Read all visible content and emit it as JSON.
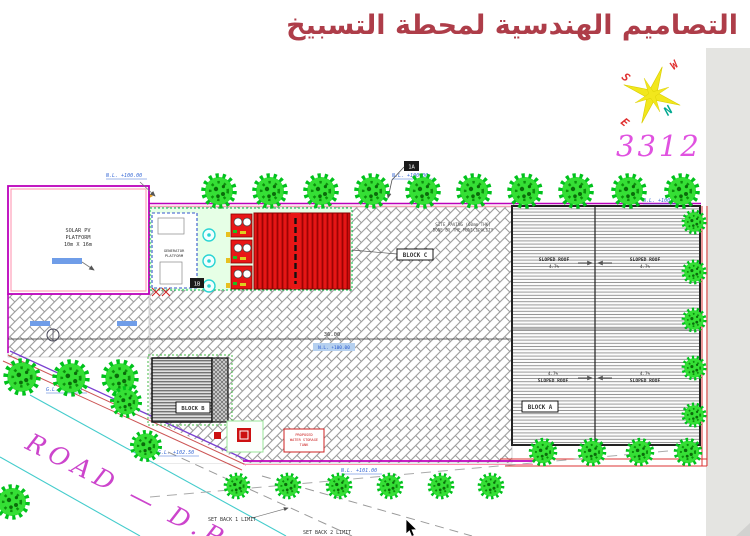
{
  "slide": {
    "title": "التصاميم الهندسية لمحطة التسبيخ",
    "drawing_number": "3312"
  },
  "colors": {
    "title": "#ae3d49",
    "drawing_number": "#e052e0",
    "road_text": "#cc44cc",
    "boundary_purple": "#bb00bb",
    "boundary_red": "#dd3333",
    "container_red": "#e51616",
    "tree_green": "#35df35",
    "level_text_blue": "#3a6bd6"
  },
  "compass": {
    "north": "N",
    "south": "S",
    "east": "E",
    "west": "W"
  },
  "plan": {
    "solar_platform": {
      "line1": "SOLAR PV",
      "line2": "PLATFORM",
      "line3": "10m X 16m"
    },
    "generator_platform": {
      "line1": "GENERATOR",
      "line2": "PLATFORM"
    },
    "blocks": {
      "a": "BLOCK A",
      "b": "BLOCK B",
      "c": "BLOCK C"
    },
    "sloped_roof": {
      "label": "SLOPED ROOF",
      "slope": "4.7%"
    },
    "municipality_note": {
      "line1": "SITE PAVING (60mm THK)",
      "line2": "DONE BY THE MUNICIPALITY"
    },
    "water_tank_note": {
      "line1": "PROPOSED",
      "line2": "WATER STORAGE",
      "line3": "TANK"
    },
    "levels": {
      "nl_100": "N.L. +100.00",
      "nl_101": "N.L. +101.00",
      "gl_100_50": "G.L. +100.50",
      "gl_102_50": "G.L. +102.50"
    },
    "dimension_36": "36.00",
    "setback1": "SET BACK 1 LIMIT",
    "setback2": "SET BACK 2 LIMIT",
    "road_label": "ROAD — D.P",
    "marker_1a": "1A",
    "marker_1b": "1B"
  }
}
